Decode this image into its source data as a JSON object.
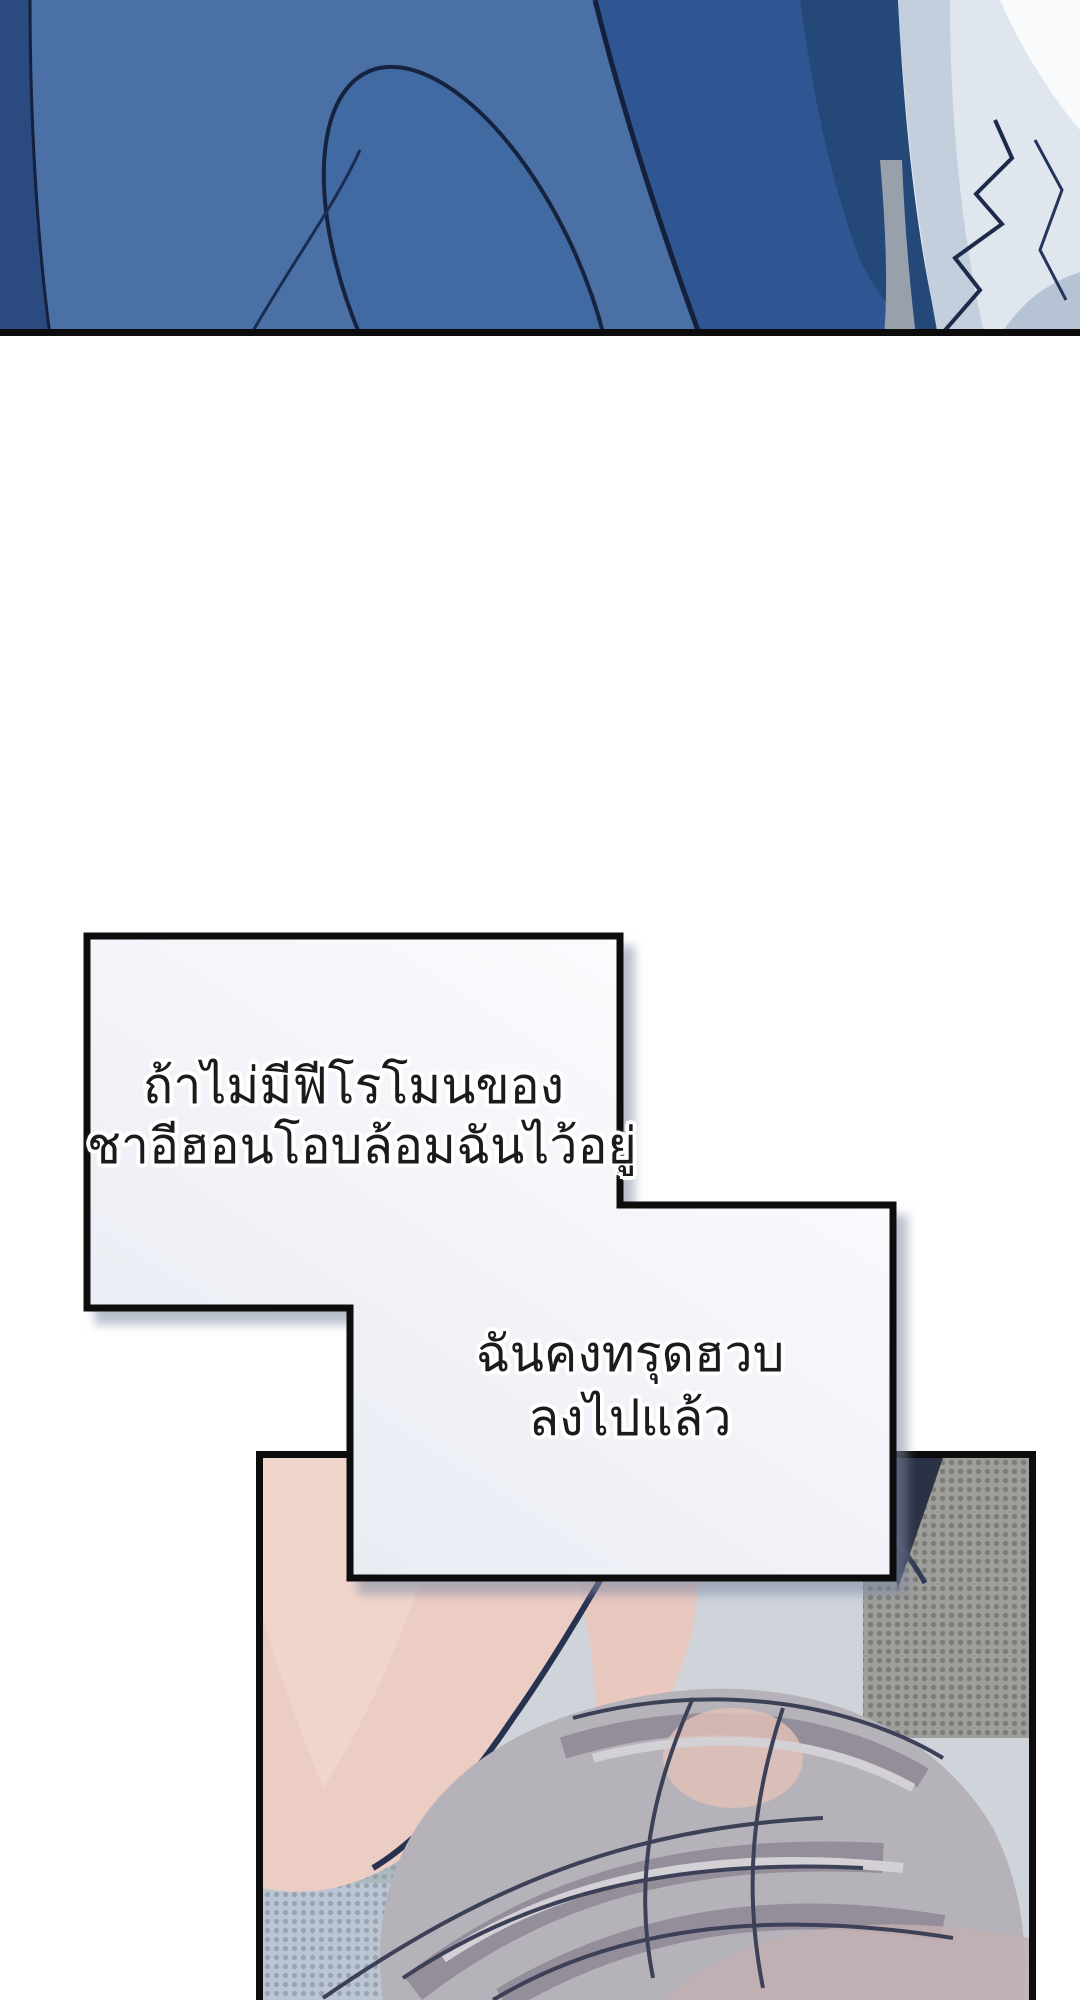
{
  "page": {
    "type": "vertical-scroll webtoon comic page",
    "width": 1080,
    "height": 2000,
    "background": "#ffffff"
  },
  "top_panel": {
    "description": "close-up of draped blue clothing (jacket/sleeve) with white frilled shirt fabric on the right, cut by a black rule at bottom",
    "colors": {
      "base_blue": "#4a70a6",
      "fold_blue": "#2f5692",
      "deep_navy": "#244878",
      "left_shadow": "#2a4a80",
      "outline": "#14203c",
      "fabric_white": "#dfe6ee",
      "fabric_shadow": "#c3cfdd",
      "fabric_deep_shadow": "#b6c3d4",
      "highlight_white": "#f8fafc",
      "gray_sliver": "#98a1ab",
      "border_black": "#0c0c0c"
    }
  },
  "speech": {
    "bubble1": {
      "line1": "ถ้าไม่มีฟีโรโมนของ",
      "line2": "ชาอีฮอนโอบล้อมฉันไว้อยู่"
    },
    "bubble2": {
      "line1": "ฉันคงทรุดฮวบ",
      "line2": "ลงไปแล้ว"
    },
    "style": {
      "fill_light": "#fdfdff",
      "fill_dark": "#e7eaf2",
      "border": "#0d0d0d",
      "text_color": "#1b1b1b",
      "halo": "#ffffff",
      "shadow": "#7d88a4"
    }
  },
  "bottom_panel": {
    "description": "person with voluminous silver-grey hair lying face down, bare pink shoulder and neck at upper left, halftone-dot walls behind",
    "colors": {
      "skin": "#eccdc4",
      "skin_highlight": "#f2d8cf",
      "skin_outline": "#273150",
      "hair_base": "#b6b2b9",
      "hair_shadow": "#948e9b",
      "hair_light": "#d3d0d6",
      "hair_dark_line": "#3c4158",
      "hair_mauve": "#c2aeb1",
      "halftone_cool_base": "#bcc5d2",
      "halftone_cool_dot": "#98a3b4",
      "halftone_teal_tint": "#8fa39d",
      "halftone_gray_base": "#9e9e9a",
      "halftone_gray_dot": "#7c7c78",
      "dark_navy_accent": "#2c3246",
      "border_black": "#0d0d0d"
    }
  }
}
